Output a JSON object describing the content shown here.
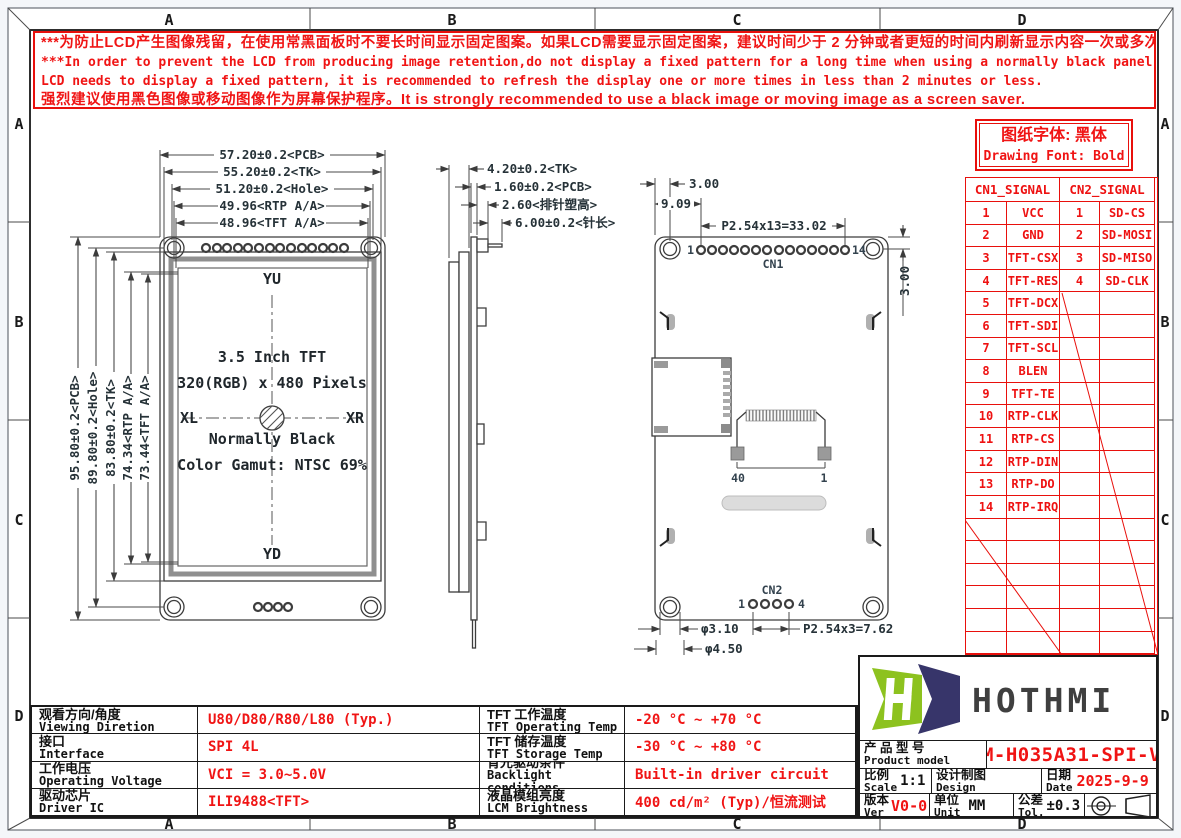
{
  "colors": {
    "accent_red": "#e8100c",
    "line_black": "#3c3c3c",
    "logo_green": "#8dc21f",
    "logo_navy": "#37356a",
    "module_gray": "#8f8f8f"
  },
  "grid": {
    "cols": [
      "A",
      "B",
      "C",
      "D"
    ],
    "rows": [
      "A",
      "B",
      "C",
      "D"
    ]
  },
  "warning": {
    "line1": "***为防止LCD产生图像残留，在使用常黑面板时不要长时间显示固定图案。如果LCD需要显示固定图案，建议时间少于 2 分钟或者更短的时间内刷新显示内容一次或多次。",
    "line2": "***In order to prevent the LCD from producing image retention,do not display a fixed pattern for a long time when using a normally black panel.If the",
    "line3": " LCD needs to display a fixed pattern, it is recommended to refresh the display one or more times in less than 2 minutes or less.",
    "line4": "强烈建议使用黑色图像或移动图像作为屏幕保护程序。It is strongly recommended to use a black image or moving image as a screen saver."
  },
  "font_note": {
    "cn": "图纸字体: 黑体",
    "en": "Drawing Font: Bold"
  },
  "signal_table": {
    "cn1_header": "CN1_SIGNAL",
    "cn2_header": "CN2_SIGNAL",
    "rows": [
      {
        "p1": "1",
        "s1": "VCC",
        "p2": "1",
        "s2": "SD-CS"
      },
      {
        "p1": "2",
        "s1": "GND",
        "p2": "2",
        "s2": "SD-MOSI"
      },
      {
        "p1": "3",
        "s1": "TFT-CSX",
        "p2": "3",
        "s2": "SD-MISO"
      },
      {
        "p1": "4",
        "s1": "TFT-RES",
        "p2": "4",
        "s2": "SD-CLK"
      },
      {
        "p1": "5",
        "s1": "TFT-DCX",
        "p2": "",
        "s2": ""
      },
      {
        "p1": "6",
        "s1": "TFT-SDI",
        "p2": "",
        "s2": ""
      },
      {
        "p1": "7",
        "s1": "TFT-SCL",
        "p2": "",
        "s2": ""
      },
      {
        "p1": "8",
        "s1": "BLEN",
        "p2": "",
        "s2": ""
      },
      {
        "p1": "9",
        "s1": "TFT-TE",
        "p2": "",
        "s2": ""
      },
      {
        "p1": "10",
        "s1": "RTP-CLK",
        "p2": "",
        "s2": ""
      },
      {
        "p1": "11",
        "s1": "RTP-CS",
        "p2": "",
        "s2": ""
      },
      {
        "p1": "12",
        "s1": "RTP-DIN",
        "p2": "",
        "s2": ""
      },
      {
        "p1": "13",
        "s1": "RTP-DO",
        "p2": "",
        "s2": ""
      },
      {
        "p1": "14",
        "s1": "RTP-IRQ",
        "p2": "",
        "s2": ""
      }
    ]
  },
  "front_view": {
    "dims_top": [
      "57.20±0.2<PCB>",
      "55.20±0.2<TK>",
      "51.20±0.2<Hole>",
      "49.96<RTP A/A>",
      "48.96<TFT A/A>"
    ],
    "dims_left": [
      "95.80±0.2<PCB>",
      "89.80±0.2<Hole>",
      "83.80±0.2<TK>",
      "74.34<RTP A/A>",
      "73.44<TFT A/A>"
    ],
    "labels": {
      "yu": "YU",
      "yd": "YD",
      "xl": "XL",
      "xr": "XR"
    },
    "center_text": [
      "3.5 Inch TFT",
      "320(RGB) x 480 Pixels",
      "Normally Black",
      "Color Gamut: NTSC 69%"
    ]
  },
  "side_view": {
    "dims": [
      "4.20±0.2<TK>",
      "1.60±0.2<PCB>",
      "2.60<排针塑高>",
      "6.00±0.2<针长>"
    ]
  },
  "back_view": {
    "dim_3_00_top": "3.00",
    "dim_9_09": "9.09",
    "dim_pitch_cn1": "P2.54x13=33.02",
    "dim_3_00_right": "3.00",
    "cn1": "CN1",
    "pin1": "1",
    "pin14": "14",
    "fpc_40": "40",
    "fpc_1": "1",
    "cn2": "CN2",
    "cn2_pin1": "1",
    "cn2_pin4": "4",
    "dim_hole": "φ3.10",
    "dim_hole_outer": "φ4.50",
    "dim_pitch_cn2": "P2.54x3=7.62"
  },
  "spec_table": {
    "rows": [
      {
        "label_cn": "观看方向/角度",
        "label_en": "Viewing Diretion",
        "value": "U80/D80/R80/L80 (Typ.)",
        "label2_cn": "TFT 工作温度",
        "label2_en": "TFT Operating Temp",
        "value2": "-20 °C ~ +70 °C"
      },
      {
        "label_cn": "接口",
        "label_en": "Interface",
        "value": "SPI 4L",
        "label2_cn": "TFT 储存温度",
        "label2_en": "TFT Storage Temp",
        "value2": "-30 °C ~ +80 °C"
      },
      {
        "label_cn": "工作电压",
        "label_en": "Operating Voltage",
        "value": "VCI = 3.0~5.0V",
        "label2_cn": "背光驱动条件",
        "label2_en": "Backlight conditions",
        "value2": "Built-in driver circuit"
      },
      {
        "label_cn": "驱动芯片",
        "label_en": "Driver IC",
        "value": "ILI9488<TFT>",
        "label2_cn": "液晶模组亮度",
        "label2_en": "LCM Brightness",
        "value2": "400 cd/m² (Typ)/恒流测试"
      }
    ]
  },
  "title_block": {
    "logo_text": "HOTHMI",
    "product_label_cn": "产 品 型 号",
    "product_label_en": "Product model",
    "product_model": "HTM-H035A31-SPI-V04",
    "scale_cn": "比例",
    "scale_en": "Scale",
    "scale_value": "1:1",
    "design_cn": "设计制图",
    "design_en": "Design",
    "design_value": "",
    "date_cn": "日期",
    "date_en": "Date",
    "date_value": "2025-9-9",
    "ver_cn": "版本",
    "ver_en": "Ver",
    "ver_value": "V0-0",
    "unit_cn": "单位",
    "unit_en": "Unit",
    "unit_value": "MM",
    "tol_cn": "公差",
    "tol_en": "Tol.",
    "tol_value": "±0.3"
  }
}
